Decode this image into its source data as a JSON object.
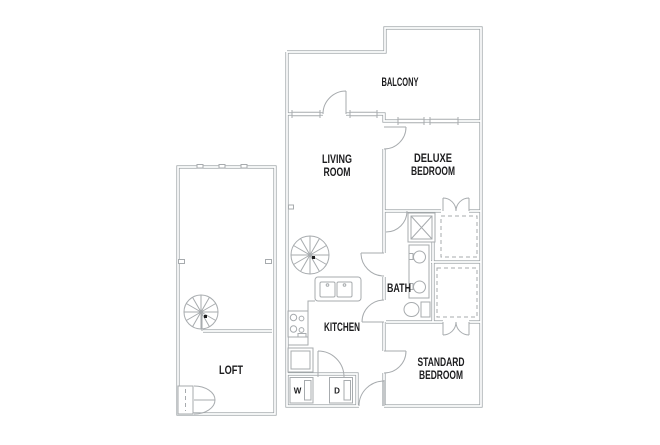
{
  "floor_plan": {
    "units": {
      "loft": {
        "name": "LOFT"
      },
      "apartment": {
        "balcony": "BALCONY",
        "living_room": [
          "LIVING",
          "ROOM"
        ],
        "deluxe_bedroom": [
          "DELUXE",
          "BEDROOM"
        ],
        "bath": "BATH",
        "kitchen": "KITCHEN",
        "standard_bedroom": [
          "STANDARD",
          "BEDROOM"
        ],
        "washer": "W",
        "dryer": "D"
      }
    },
    "colors": {
      "background": "#ffffff",
      "wall": "#9aa0a3",
      "fixture": "#a7abae",
      "text": "#1c1c1e"
    }
  }
}
